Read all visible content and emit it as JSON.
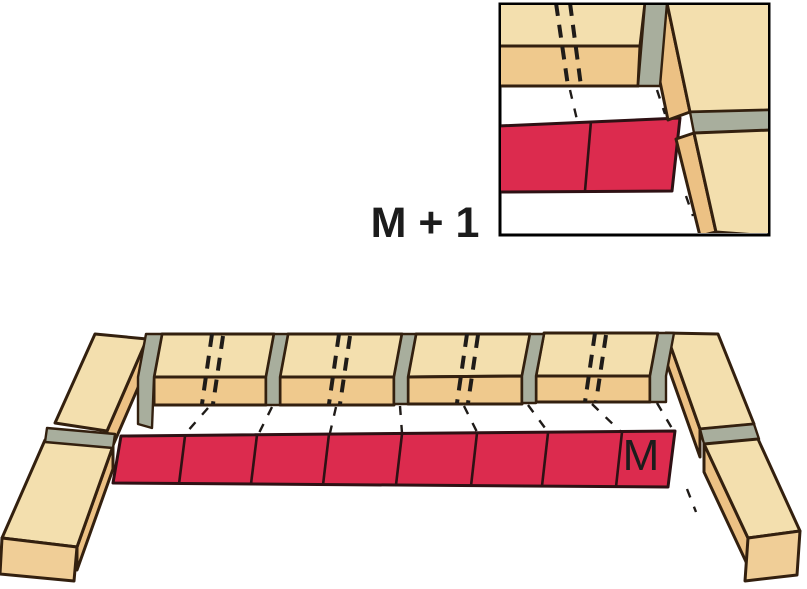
{
  "figure": {
    "type": "masonry-gauging-diagram",
    "labels": {
      "module": "M",
      "module_plus_one": "M + 1"
    },
    "colors": {
      "background": "#FFFFFF",
      "brick_top": "#F3DFAE",
      "brick_front": "#EFC98D",
      "brick_side": "#ECC184",
      "brick_end": "#F0CE97",
      "mortar": "#A8AE9D",
      "outline": "#33200F",
      "marker_red": "#DC2B4E",
      "marker_outline": "#2E1114",
      "dash": "#1F1B18",
      "label": "#1C1C1C"
    },
    "counts": {
      "course_stretcher_bricks": 4,
      "marker_segments": 8,
      "inset_marker_segments": 2
    }
  }
}
